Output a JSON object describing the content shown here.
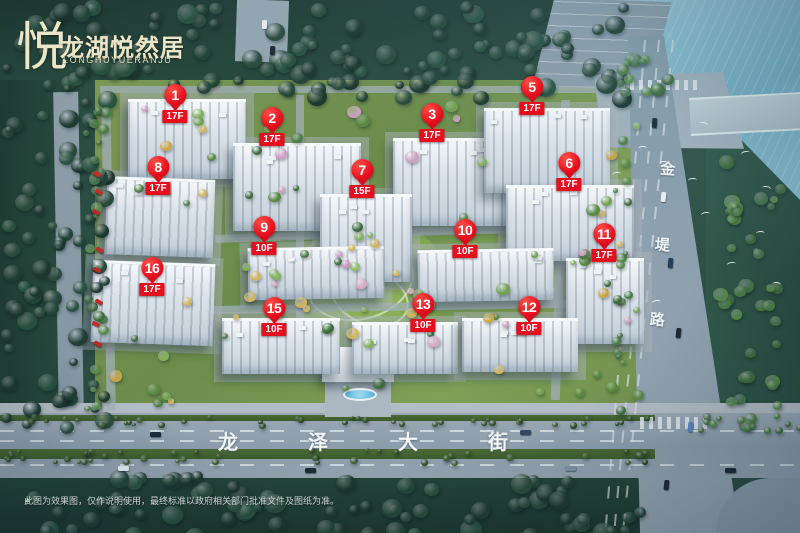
{
  "logo": {
    "mark": "悦",
    "title": "龙湖悦然居",
    "subtitle": "LONGHUYUERANJU"
  },
  "streets": {
    "main": "龙泽大街",
    "side": "金堤路"
  },
  "disclaimer": {
    "bullet": "▲",
    "text": "此图为效果图，仅作说明使用，最终标准以政府相关部门批准文件及图纸为准。"
  },
  "watermark": {
    "glyph": "e"
  },
  "palette": {
    "marker_red": "#e60f1e",
    "logo_cream": "#ece6c8",
    "water_blue": "#7cb4c8",
    "road_gray": "#8d9dab",
    "street_text_white": "#f3f6f7"
  },
  "markers": [
    {
      "num": "1",
      "floor": "17F",
      "x": 175,
      "y": 95
    },
    {
      "num": "2",
      "floor": "17F",
      "x": 272,
      "y": 118
    },
    {
      "num": "3",
      "floor": "17F",
      "x": 432,
      "y": 114
    },
    {
      "num": "5",
      "floor": "17F",
      "x": 532,
      "y": 87
    },
    {
      "num": "6",
      "floor": "17F",
      "x": 569,
      "y": 163
    },
    {
      "num": "7",
      "floor": "15F",
      "x": 362,
      "y": 170
    },
    {
      "num": "8",
      "floor": "17F",
      "x": 158,
      "y": 167
    },
    {
      "num": "9",
      "floor": "10F",
      "x": 264,
      "y": 227
    },
    {
      "num": "10",
      "floor": "10F",
      "x": 465,
      "y": 230
    },
    {
      "num": "11",
      "floor": "17F",
      "x": 604,
      "y": 234
    },
    {
      "num": "12",
      "floor": "10F",
      "x": 529,
      "y": 307
    },
    {
      "num": "13",
      "floor": "10F",
      "x": 423,
      "y": 304
    },
    {
      "num": "15",
      "floor": "10F",
      "x": 274,
      "y": 308
    },
    {
      "num": "16",
      "floor": "17F",
      "x": 152,
      "y": 268
    }
  ]
}
